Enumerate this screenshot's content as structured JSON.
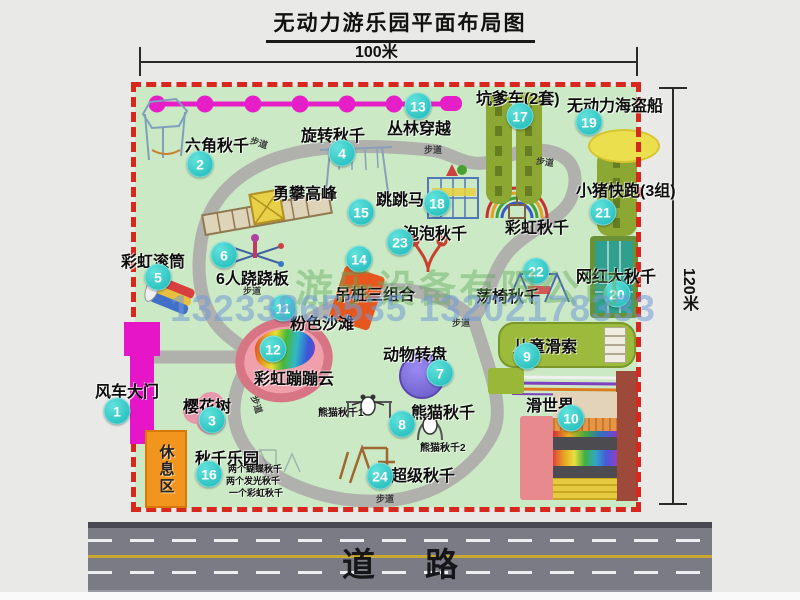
{
  "title": "无动力游乐园平面布局图",
  "dimension_labels": {
    "top": "100米",
    "right": "120米"
  },
  "road_label": "道路",
  "rest_area_label": "休息区",
  "watermark": {
    "company": "游乐设备有限公司",
    "phone": "13233865535 13202178333"
  },
  "colors": {
    "park_green": "#cbe9c4",
    "boundary_red": "#d8281e",
    "badge_teal": "#1fc7c3",
    "gate_magenta": "#e616c8",
    "zipline_magenta": "#e61ec8",
    "road_gray": "#7b7b85",
    "rest_orange": "#f2951e",
    "pirate_yellow": "#ecdf4e",
    "turntable_purple": "#6656c6",
    "beach_pink": "#efa0ab"
  },
  "park_items": [
    {
      "num": "1",
      "label": "风车大门",
      "bx": 117,
      "by": 411,
      "lx": 95,
      "ly": 378
    },
    {
      "num": "2",
      "label": "六角秋千",
      "bx": 200,
      "by": 164,
      "lx": 185,
      "ly": 132
    },
    {
      "num": "3",
      "label": "樱花树",
      "bx": 212,
      "by": 420,
      "lx": 183,
      "ly": 393
    },
    {
      "num": "4",
      "label": "旋转秋千",
      "bx": 342,
      "by": 153,
      "lx": 301,
      "ly": 122
    },
    {
      "num": "5",
      "label": "彩虹滚筒",
      "bx": 158,
      "by": 277,
      "lx": 121,
      "ly": 248
    },
    {
      "num": "6",
      "label": "6人跷跷板",
      "bx": 224,
      "by": 255,
      "lx": 216,
      "ly": 265
    },
    {
      "num": "7",
      "label": "动物转盘",
      "bx": 440,
      "by": 373,
      "lx": 383,
      "ly": 341
    },
    {
      "num": "8",
      "label": "熊猫秋千",
      "bx": 402,
      "by": 424,
      "lx": 411,
      "ly": 399
    },
    {
      "num": "9",
      "label": "儿童滑索",
      "bx": 527,
      "by": 356,
      "lx": 513,
      "ly": 333
    },
    {
      "num": "10",
      "label": "滑世界",
      "bx": 571,
      "by": 418,
      "lx": 526,
      "ly": 392
    },
    {
      "num": "11",
      "label": "粉色沙滩",
      "bx": 283,
      "by": 308,
      "lx": 290,
      "ly": 310
    },
    {
      "num": "12",
      "label": "彩虹蹦蹦云",
      "bx": 273,
      "by": 349,
      "lx": 254,
      "ly": 365
    },
    {
      "num": "13",
      "label": "丛林穿越",
      "bx": 418,
      "by": 106,
      "lx": 387,
      "ly": 115
    },
    {
      "num": "14",
      "label": "吊桩三组合",
      "bx": 359,
      "by": 259,
      "lx": 335,
      "ly": 281
    },
    {
      "num": "15",
      "label": "勇攀高峰",
      "bx": 361,
      "by": 212,
      "lx": 273,
      "ly": 180
    },
    {
      "num": "16",
      "label": "秋千乐园",
      "bx": 209,
      "by": 474,
      "lx": 195,
      "ly": 445
    },
    {
      "num": "17",
      "label": "坑爹车(2套)",
      "bx": 520,
      "by": 116,
      "lx": 476,
      "ly": 85
    },
    {
      "num": "18",
      "label": "跳跳马",
      "bx": 437,
      "by": 203,
      "lx": 376,
      "ly": 186
    },
    {
      "num": "19",
      "label": "无动力海盗船",
      "bx": 589,
      "by": 122,
      "lx": 567,
      "ly": 92
    },
    {
      "num": "20",
      "label": "网红大秋千",
      "bx": 617,
      "by": 294,
      "lx": 576,
      "ly": 263
    },
    {
      "num": "21",
      "label": "小猪快跑(3组)",
      "bx": 603,
      "by": 212,
      "lx": 576,
      "ly": 177
    },
    {
      "num": "22",
      "label": "荡椅秋千",
      "bx": 536,
      "by": 271,
      "lx": 476,
      "ly": 283
    },
    {
      "num": "23",
      "label": "泡泡秋千",
      "bx": 400,
      "by": 242,
      "lx": 403,
      "ly": 220
    },
    {
      "num": "24",
      "label": "超级秋千",
      "bx": 380,
      "by": 476,
      "lx": 391,
      "ly": 462
    }
  ],
  "extra_labels": [
    {
      "text": "彩虹秋千",
      "x": 505,
      "y": 214,
      "size": 16
    },
    {
      "text": "熊猫秋千1",
      "x": 318,
      "y": 404,
      "size": 10
    },
    {
      "text": "熊猫秋千2",
      "x": 420,
      "y": 439,
      "size": 10
    },
    {
      "text": "两个蝴蝶秋千",
      "x": 228,
      "y": 462,
      "size": 9
    },
    {
      "text": "两个发光秋千",
      "x": 226,
      "y": 474,
      "size": 9
    },
    {
      "text": "一个彩虹秋千",
      "x": 229,
      "y": 486,
      "size": 9
    }
  ],
  "path_labels": [
    {
      "text": "步道",
      "x": 250,
      "y": 136,
      "r": 18
    },
    {
      "text": "步道",
      "x": 424,
      "y": 143,
      "r": 0
    },
    {
      "text": "步道",
      "x": 536,
      "y": 155,
      "r": 8
    },
    {
      "text": "步道",
      "x": 243,
      "y": 284,
      "r": 0
    },
    {
      "text": "步道",
      "x": 452,
      "y": 316,
      "r": 0
    },
    {
      "text": "步道",
      "x": 376,
      "y": 492,
      "r": 0
    },
    {
      "text": "步道",
      "x": 248,
      "y": 398,
      "r": 72
    }
  ]
}
